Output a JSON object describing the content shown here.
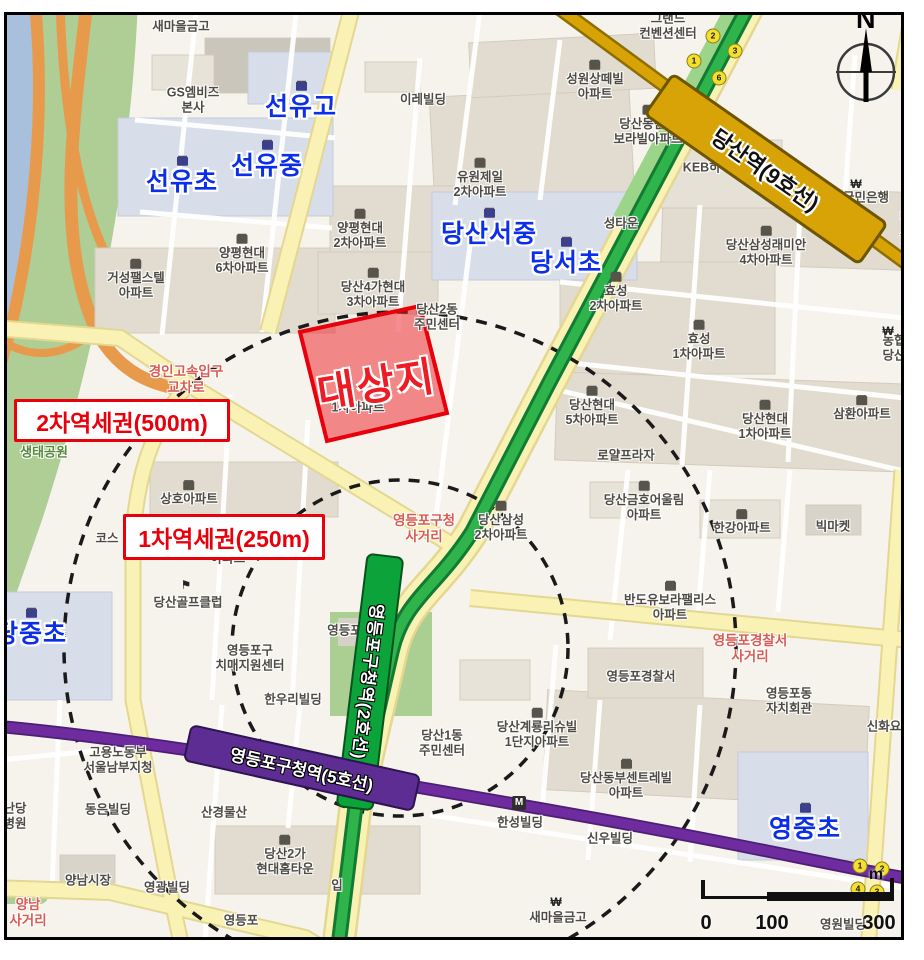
{
  "map": {
    "title": "당산동 대상지 역세권 지도",
    "site": {
      "label": "대상지",
      "fill": "#ED1C24",
      "border": "#E8000B"
    },
    "zones": {
      "primary": {
        "label": "1차역세권(250m)",
        "radius_m": 250
      },
      "secondary": {
        "label": "2차역세권(500m)",
        "radius_m": 500
      }
    },
    "lines": {
      "line2": {
        "station": "영등포구청역(2호선)",
        "color": "#0CA33A"
      },
      "line5": {
        "station": "영등포구청역(5호선)",
        "color": "#5E2D94"
      },
      "line9": {
        "station": "당산역(9호선)",
        "color": "#D7A306"
      }
    },
    "compass": {
      "letter": "N"
    },
    "scale": {
      "tick0": "0",
      "tick100": "100",
      "tick300": "300",
      "unit": "m"
    },
    "colors": {
      "background": "#F6F3ED",
      "water": "#A8C0DC",
      "park": "#AECE96",
      "highway": "#E89A4C",
      "road_yellow": "#FAF2B4",
      "school_text": "#0B2EE8",
      "label_text": "#4d4b44",
      "accent_red": "#E8000B"
    },
    "labels": [
      {
        "name": "label-saemaul-geumgo-top",
        "text": "새마을금고",
        "x": 181,
        "y": 27,
        "t": "b"
      },
      {
        "name": "label-gs-mbiz",
        "text": "GS엠비즈\n본사",
        "x": 193,
        "y": 100,
        "t": "b"
      },
      {
        "name": "label-seonyu-high-school",
        "text": "선유고",
        "x": 301,
        "y": 102,
        "t": "school"
      },
      {
        "name": "label-seonyu-middle-school",
        "text": "선유중",
        "x": 267,
        "y": 161,
        "t": "school"
      },
      {
        "name": "label-seonyu-elementary",
        "text": "선유초",
        "x": 182,
        "y": 177,
        "t": "school"
      },
      {
        "name": "label-ire-building",
        "text": "이레빌딩",
        "x": 423,
        "y": 100,
        "t": "b"
      },
      {
        "name": "label-grand-convention",
        "text": "그랜드\n컨벤션센터",
        "x": 668,
        "y": 26,
        "t": "b"
      },
      {
        "name": "label-seongwon-santevill",
        "text": "성원상떼빌\n아파트",
        "x": 595,
        "y": 81,
        "t": "apt"
      },
      {
        "name": "label-dangsan-bando-borabill",
        "text": "당산동반도\n보라빌아파트",
        "x": 648,
        "y": 126,
        "t": "apt"
      },
      {
        "name": "label-keb-hana-bank",
        "text": "KEB하나은행",
        "x": 719,
        "y": 168,
        "t": "b"
      },
      {
        "name": "label-kookmin-bank",
        "text": "국민은행",
        "x": 866,
        "y": 198,
        "t": "b"
      },
      {
        "name": "label-dangsan-partial",
        "text": "당산",
        "x": 906,
        "y": 227,
        "t": "red"
      },
      {
        "name": "label-samsung-raemian-4cha",
        "text": "당산삼성래미안\n4차아파트",
        "x": 766,
        "y": 247,
        "t": "apt"
      },
      {
        "name": "label-seongtaun-partial",
        "text": "성타운",
        "x": 621,
        "y": 224,
        "t": "b"
      },
      {
        "name": "label-yuwon-jeil-2cha",
        "text": "유원제일\n2차아파트",
        "x": 480,
        "y": 179,
        "t": "apt"
      },
      {
        "name": "label-yangpyeong-hyundai-2cha",
        "text": "양평현대\n2차아파트",
        "x": 360,
        "y": 230,
        "t": "apt"
      },
      {
        "name": "label-dangsan-seo-middle-school",
        "text": "당산서중",
        "x": 489,
        "y": 229,
        "t": "school"
      },
      {
        "name": "label-dangseo-elementary",
        "text": "당서초",
        "x": 566,
        "y": 258,
        "t": "school"
      },
      {
        "name": "label-yangpyeong-hyundai-6cha",
        "text": "양평현대\n6차아파트",
        "x": 242,
        "y": 255,
        "t": "apt"
      },
      {
        "name": "label-geoseong-apt",
        "text": "거성팰스텔\n아파트",
        "x": 136,
        "y": 280,
        "t": "apt"
      },
      {
        "name": "label-dangsan4ga-hyundai-3cha",
        "text": "당산4가현대\n3차아파트",
        "x": 373,
        "y": 289,
        "t": "apt"
      },
      {
        "name": "label-dangsan-2dong-center",
        "text": "당산2동\n주민센터",
        "x": 437,
        "y": 317,
        "t": "b"
      },
      {
        "name": "label-hyosung-2cha",
        "text": "효성\n2차아파트",
        "x": 616,
        "y": 293,
        "t": "apt"
      },
      {
        "name": "label-hyosung-1cha",
        "text": "효성\n1차아파트",
        "x": 699,
        "y": 341,
        "t": "apt"
      },
      {
        "name": "label-nonghyup-dangsan",
        "text": "농협\n당산",
        "x": 894,
        "y": 348,
        "t": "b"
      },
      {
        "name": "label-gyeongin-expressway-intersection",
        "text": "경인고속입구\n교차로",
        "x": 186,
        "y": 380,
        "t": "red"
      },
      {
        "name": "label-ecology-park",
        "text": "생태공원",
        "x": 44,
        "y": 452,
        "t": "green"
      },
      {
        "name": "label-yuwon-jeil-1cha-partial",
        "text": "1차아파트",
        "x": 358,
        "y": 408,
        "t": "b"
      },
      {
        "name": "label-dangsan-hyundai-5cha",
        "text": "당산현대\n5차아파트",
        "x": 592,
        "y": 407,
        "t": "apt"
      },
      {
        "name": "label-dangsan-hyundai-1cha",
        "text": "당산현대\n1차아파트",
        "x": 765,
        "y": 421,
        "t": "apt"
      },
      {
        "name": "label-samhwan-apt",
        "text": "삼환아파트",
        "x": 862,
        "y": 409,
        "t": "apt"
      },
      {
        "name": "label-royal-plaza",
        "text": "로얄프라자",
        "x": 626,
        "y": 456,
        "t": "b"
      },
      {
        "name": "label-sangho-apt",
        "text": "상호아파트",
        "x": 189,
        "y": 494,
        "t": "apt"
      },
      {
        "name": "label-dangsan-samsung-2cha",
        "text": "당산삼성\n2차아파트",
        "x": 501,
        "y": 522,
        "t": "apt"
      },
      {
        "name": "label-dangsan-kumho",
        "text": "당산금호어울림\n아파트",
        "x": 644,
        "y": 502,
        "t": "apt"
      },
      {
        "name": "label-hangang-apt",
        "text": "한강아파트",
        "x": 742,
        "y": 523,
        "t": "apt"
      },
      {
        "name": "label-big-market",
        "text": "빅마켓",
        "x": 833,
        "y": 527,
        "t": "b"
      },
      {
        "name": "label-ydp-office-intersection",
        "text": "영등포구청\n사거리",
        "x": 424,
        "y": 529,
        "t": "red"
      },
      {
        "name": "label-cosmos-partial",
        "text": "코스",
        "x": 107,
        "y": 539,
        "t": "b"
      },
      {
        "name": "label-apt-partial",
        "text": "아파트",
        "x": 228,
        "y": 559,
        "t": "b"
      },
      {
        "name": "label-dangsan-golf-club",
        "text": "당산골프클럽",
        "x": 188,
        "y": 603,
        "t": "b"
      },
      {
        "name": "label-dangjung-elementary",
        "text": "당중초",
        "x": 31,
        "y": 629,
        "t": "school"
      },
      {
        "name": "label-ydp-district-office",
        "text": "영등포구청",
        "x": 356,
        "y": 631,
        "t": "b"
      },
      {
        "name": "label-bando-ubora-palace",
        "text": "반도유보라팰리스\n아파트",
        "x": 670,
        "y": 602,
        "t": "apt"
      },
      {
        "name": "label-dementia-center",
        "text": "영등포구\n치매지원센터",
        "x": 250,
        "y": 658,
        "t": "b"
      },
      {
        "name": "label-police-intersection",
        "text": "영등포경찰서\n사거리",
        "x": 750,
        "y": 649,
        "t": "red"
      },
      {
        "name": "label-ydp-police-station",
        "text": "영등포경찰서",
        "x": 641,
        "y": 677,
        "t": "b"
      },
      {
        "name": "label-hanwoori-building",
        "text": "한우리빌딩",
        "x": 293,
        "y": 700,
        "t": "b"
      },
      {
        "name": "label-ydp-dong-hall",
        "text": "영등포동\n자치회관",
        "x": 789,
        "y": 701,
        "t": "b"
      },
      {
        "name": "label-shinhwa-partial",
        "text": "신화요",
        "x": 884,
        "y": 727,
        "t": "b"
      },
      {
        "name": "label-dangsan-1dong-center",
        "text": "당산1동\n주민센터",
        "x": 442,
        "y": 743,
        "t": "b"
      },
      {
        "name": "label-gyeryong-richeville",
        "text": "당산계룡리슈빌\n1단지아파트",
        "x": 537,
        "y": 729,
        "t": "apt"
      },
      {
        "name": "label-labor-ministry",
        "text": "고용노동부\n서울남부지청",
        "x": 118,
        "y": 760,
        "t": "b"
      },
      {
        "name": "label-centreville-apt",
        "text": "당산동부센트레빌\n아파트",
        "x": 626,
        "y": 780,
        "t": "apt"
      },
      {
        "name": "label-hospital-partial",
        "text": "난당\n병원",
        "x": 15,
        "y": 816,
        "t": "b"
      },
      {
        "name": "label-dongeun-building",
        "text": "동은빌딩",
        "x": 108,
        "y": 810,
        "t": "b"
      },
      {
        "name": "label-sangyeong-mulsan",
        "text": "산경물산",
        "x": 224,
        "y": 813,
        "t": "b"
      },
      {
        "name": "label-hanseong-building",
        "text": "한성빌딩",
        "x": 520,
        "y": 823,
        "t": "b"
      },
      {
        "name": "label-shinwoo-building",
        "text": "신우빌딩",
        "x": 610,
        "y": 839,
        "t": "b"
      },
      {
        "name": "label-yeongjung-elementary",
        "text": "영중초",
        "x": 805,
        "y": 824,
        "t": "school"
      },
      {
        "name": "label-hyundai-hometown",
        "text": "당산2가\n현대홈타운",
        "x": 285,
        "y": 856,
        "t": "apt"
      },
      {
        "name": "label-entrance-partial",
        "text": "입",
        "x": 337,
        "y": 886,
        "t": "b"
      },
      {
        "name": "label-yangnam-market",
        "text": "양남시장",
        "x": 88,
        "y": 881,
        "t": "b"
      },
      {
        "name": "label-yeonggwang-building",
        "text": "영광빌딩",
        "x": 167,
        "y": 888,
        "t": "b"
      },
      {
        "name": "label-yangnam-intersection",
        "text": "양남\n사거리",
        "x": 28,
        "y": 913,
        "t": "red"
      },
      {
        "name": "label-ydp-partial",
        "text": "영등포",
        "x": 241,
        "y": 921,
        "t": "b"
      },
      {
        "name": "label-saemaul-geumgo-bottom",
        "text": "새마을금고",
        "x": 558,
        "y": 918,
        "t": "b"
      },
      {
        "name": "label-yeongwon-building",
        "text": "영원빌딩",
        "x": 843,
        "y": 925,
        "t": "b"
      }
    ],
    "icons": [
      {
        "name": "won-bank-icon",
        "g": "₩",
        "x": 719,
        "y": 151
      },
      {
        "name": "won-bank-icon",
        "g": "₩",
        "x": 856,
        "y": 184
      },
      {
        "name": "won-bank-icon",
        "g": "₩",
        "x": 888,
        "y": 331
      },
      {
        "name": "won-bank-icon",
        "g": "₩",
        "x": 556,
        "y": 902
      },
      {
        "name": "golf-flag-icon",
        "g": "⚑",
        "x": 186,
        "y": 585
      },
      {
        "name": "subway-entrance-icon",
        "g": "M",
        "x": 519,
        "y": 803,
        "cls": "m"
      }
    ],
    "exits": [
      {
        "name": "exit-2",
        "n": "2",
        "x": 713,
        "y": 36
      },
      {
        "name": "exit-3",
        "n": "3",
        "x": 735,
        "y": 51
      },
      {
        "name": "exit-1",
        "n": "1",
        "x": 694,
        "y": 61
      },
      {
        "name": "exit-6",
        "n": "6",
        "x": 719,
        "y": 78
      },
      {
        "name": "exit-11",
        "n": "11",
        "x": 664,
        "y": 122
      },
      {
        "name": "exit-10",
        "n": "10",
        "x": 702,
        "y": 129
      },
      {
        "name": "exit-1b",
        "n": "1",
        "x": 860,
        "y": 866
      },
      {
        "name": "exit-2b",
        "n": "2",
        "x": 882,
        "y": 869
      },
      {
        "name": "exit-4b",
        "n": "4",
        "x": 858,
        "y": 889
      },
      {
        "name": "exit-3b",
        "n": "3",
        "x": 877,
        "y": 892
      }
    ]
  }
}
